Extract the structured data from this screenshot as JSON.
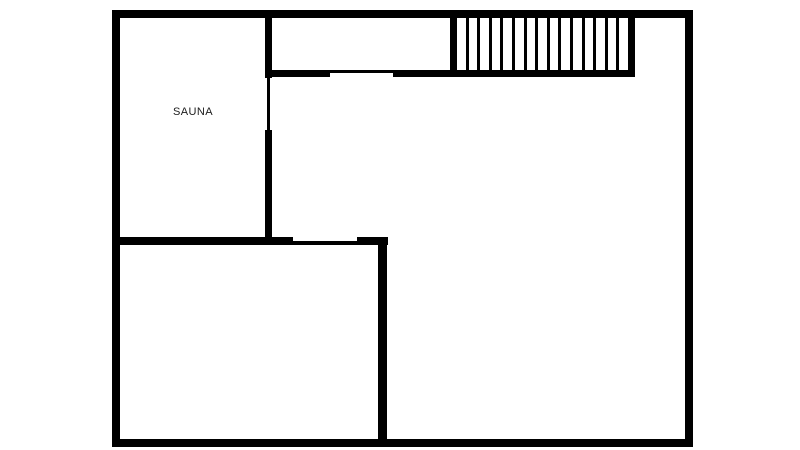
{
  "page": {
    "background": "#ffffff"
  },
  "plan": {
    "wall_color": "#000000",
    "label_color": "#1b1b1b",
    "rooms": [
      {
        "label": "SAUNA"
      }
    ],
    "staircase": {
      "tread_count": 14
    }
  }
}
